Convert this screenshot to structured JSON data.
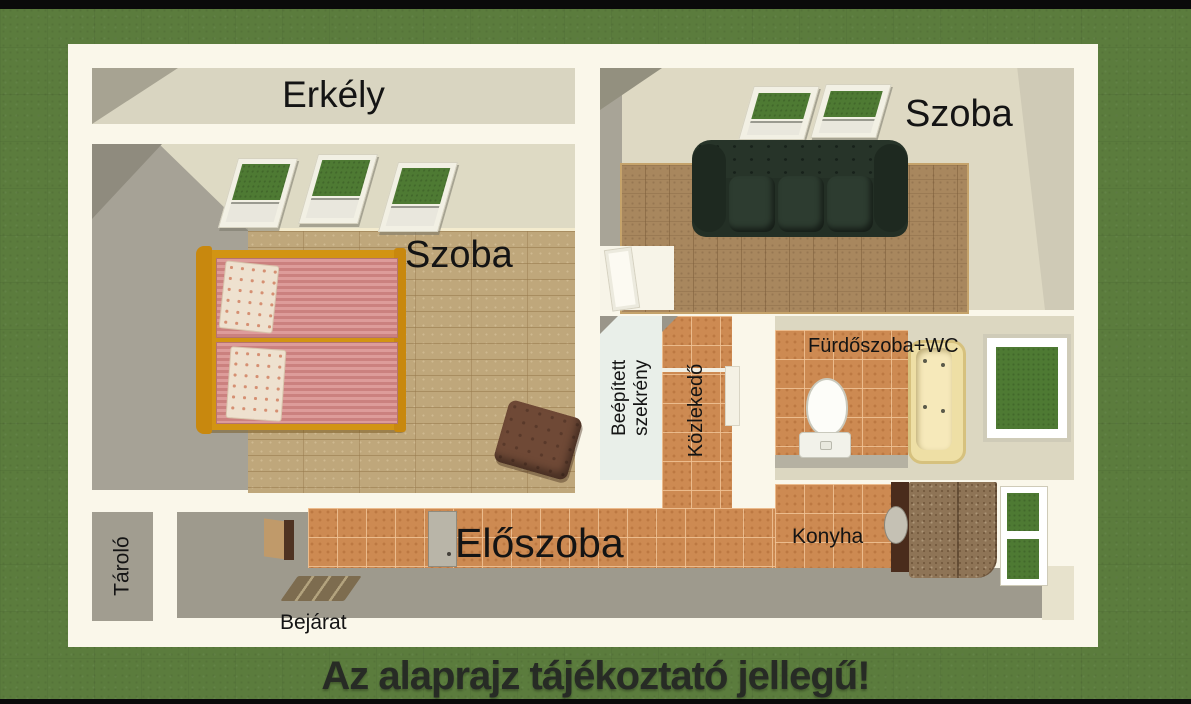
{
  "banner": {
    "text": "Az alaprajz tájékoztató jellegű!"
  },
  "rooms": {
    "balcony": {
      "label": "Erkély"
    },
    "bedroom": {
      "label": "Szoba"
    },
    "living_room": {
      "label": "Szoba"
    },
    "wardrobe": {
      "line1": "Beépített",
      "line2": "szekrény"
    },
    "corridor": {
      "label": "Közlekedő"
    },
    "bathroom": {
      "label": "Fürdőszoba+WC"
    },
    "storage": {
      "label": "Tároló"
    },
    "hall": {
      "label": "Előszoba"
    },
    "kitchen": {
      "label": "Konyha"
    },
    "entrance": {
      "label": "Bejárat"
    }
  },
  "palette": {
    "grass_background": "#5b7c3d",
    "plan_frame": "#faf7ea",
    "tile_floor": "#cd8a52",
    "wood_floor_left": "#bfa77b",
    "wood_floor_right": "#a8875e",
    "wall_beige": "#ded9c3",
    "wall_grey": "#a6a296",
    "glass_green": "#4e7a33",
    "sofa_green": "#232f25",
    "bed_frame_gold": "#d29413",
    "mattress_pink": "#d4928f",
    "bathtub_cream": "#eedfa5",
    "counter_brown": "#8e7456",
    "label_text": "#141414",
    "banner_text": "#272b25"
  }
}
